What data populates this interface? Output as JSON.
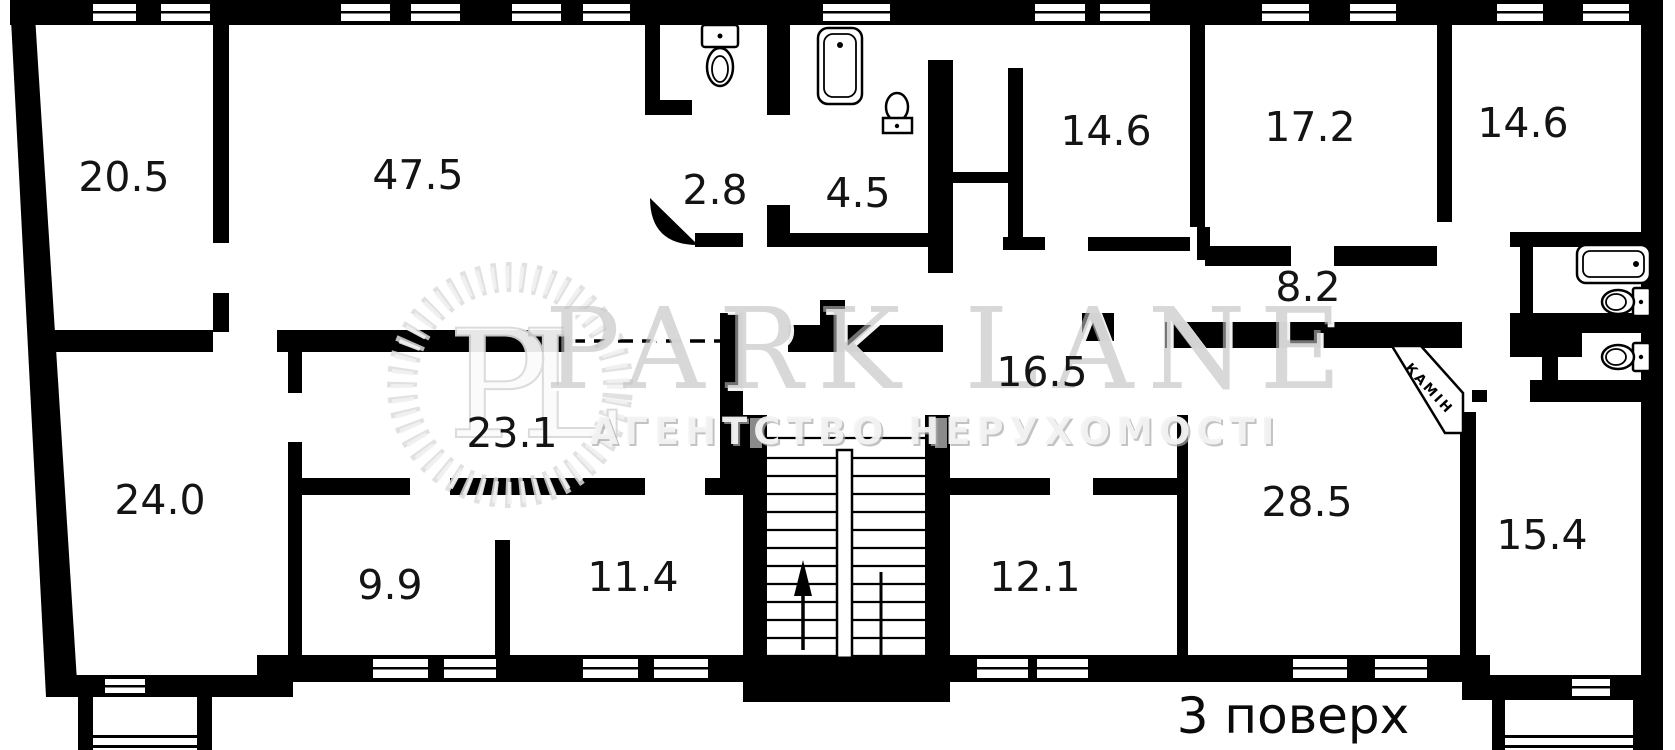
{
  "plan": {
    "floor_label": "3 поверх",
    "fireplace_label": "КАМІН",
    "rooms": [
      {
        "name": "room-20-5",
        "area": "20.5"
      },
      {
        "name": "room-47-5",
        "area": "47.5"
      },
      {
        "name": "room-2-8",
        "area": "2.8"
      },
      {
        "name": "room-4-5",
        "area": "4.5"
      },
      {
        "name": "room-14-6-a",
        "area": "14.6"
      },
      {
        "name": "room-17-2",
        "area": "17.2"
      },
      {
        "name": "room-14-6-b",
        "area": "14.6"
      },
      {
        "name": "corridor-8-2",
        "area": "8.2"
      },
      {
        "name": "hall-16-5",
        "area": "16.5"
      },
      {
        "name": "room-23-1",
        "area": "23.1"
      },
      {
        "name": "room-24-0",
        "area": "24.0"
      },
      {
        "name": "room-9-9",
        "area": "9.9"
      },
      {
        "name": "room-11-4",
        "area": "11.4"
      },
      {
        "name": "room-12-1",
        "area": "12.1"
      },
      {
        "name": "room-28-5",
        "area": "28.5"
      },
      {
        "name": "room-15-4",
        "area": "15.4"
      }
    ],
    "fixtures": [
      "toilet-icon",
      "bathtub-vertical-icon",
      "sink-icon",
      "bathtub-horizontal-icon",
      "toilet-side-icon",
      "toilet-side-icon",
      "staircase-up-arrow-icon",
      "fireplace-icon"
    ]
  },
  "watermark": {
    "monogram": "PL",
    "title": "PARK LANE",
    "subtitle": "АГЕНТСТВО НЕРУХОМОСТІ"
  },
  "colors": {
    "wall": "#000000",
    "background": "#ffffff",
    "watermark_gray": "#c6c6c6",
    "door_frame_gray": "#8a8a8a"
  }
}
